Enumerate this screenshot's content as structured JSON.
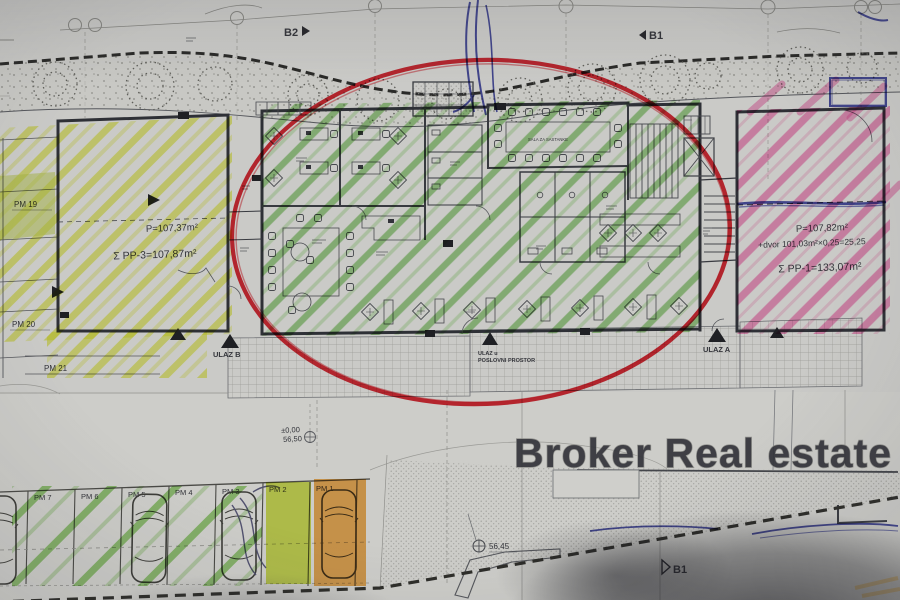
{
  "watermark": "Broker Real estate",
  "flags": {
    "b2": "B2",
    "b1_top": "B1",
    "b1_bottom": "B1"
  },
  "unit_left": {
    "area": "P=107,37m²",
    "total": "Σ PP-3=107,87m²"
  },
  "unit_right": {
    "area": "P=107,82m²",
    "yard": "+dvor 101,03m²×0,25=25,25",
    "total": "Σ PP-1=133,07m²"
  },
  "rooms": {
    "meeting": "SALA ZA SASTANKE"
  },
  "entrances": {
    "ulaz_b": "ULAZ B",
    "ulaz_a": "ULAZ A",
    "main1": "ULAZ u",
    "main2": "POSLOVNI PROSTOR"
  },
  "levels": {
    "zero": "±0,00",
    "upper": "56,50",
    "lower": "56,45"
  },
  "parking_left": [
    "PM 19",
    "PM 20",
    "PM 21"
  ],
  "parking_bottom": [
    "PM 7",
    "PM 6",
    "PM 5",
    "PM 4",
    "PM 3",
    "PM 2",
    "PM 1"
  ],
  "colors": {
    "paper": "#cdcdc9",
    "red_circle": "#d8242f",
    "yellow_hl": "#e6ed45",
    "green_hl": "#6fc24a",
    "pink_hl": "#ee62a8",
    "orange_hl": "#f0a23a",
    "yellow_green_hl": "#cadf2e",
    "blue_pen": "#31379e"
  }
}
